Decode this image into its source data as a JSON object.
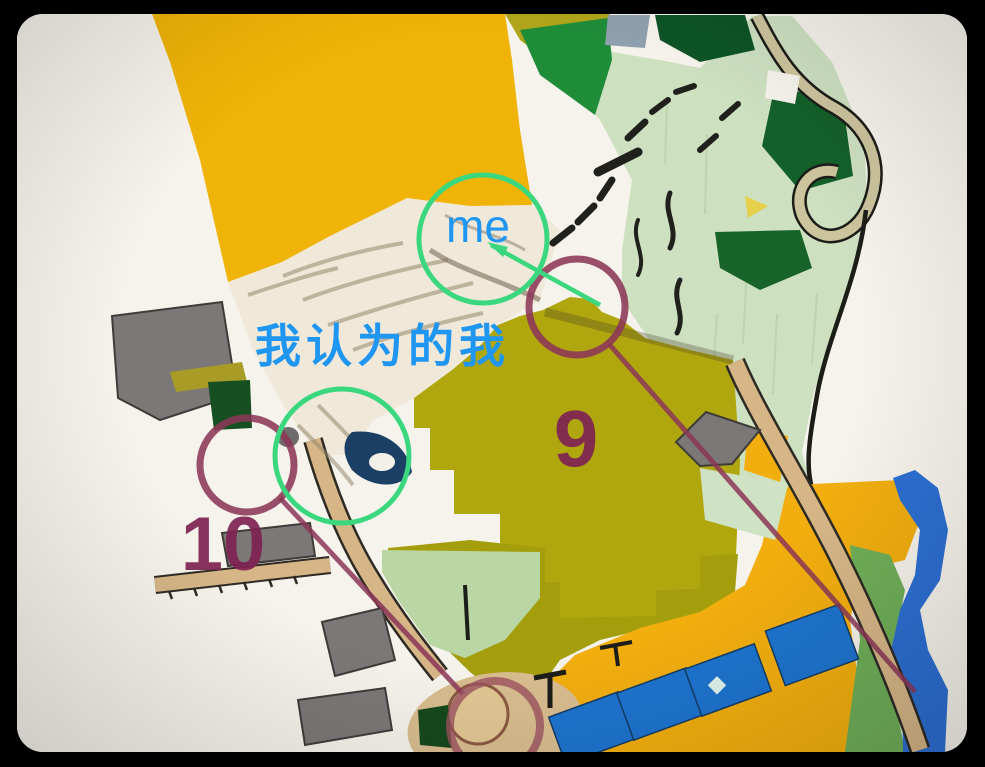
{
  "annotations": {
    "me_label": "me",
    "self_perception_label": "我认为的我",
    "label_color": "#1f96f2",
    "highlight_circle_color": "#3bd77f",
    "control_9_number": "9",
    "control_10_number": "10",
    "control_number_color": "#7f2353",
    "course_color": "#8c3757"
  },
  "map_palette": {
    "frame_background": "#000000",
    "paper": "#f6f3ec",
    "field_yellow": "#f0b307",
    "field_olive": "#b0a60e",
    "rough_open_pale_green": "#cde0c0",
    "forest_dark_green": "#0d5426",
    "forest_medium_green": "#1f8c38",
    "vegetation_band_green": "#6fae58",
    "water_blue": "#2c6fd2",
    "building_blue": "#1e74cf",
    "building_gray": "#7b7877",
    "road_tan": "#d6b687",
    "quarry_sand": "#f0e9d9",
    "cliff_black": "#20201c"
  }
}
